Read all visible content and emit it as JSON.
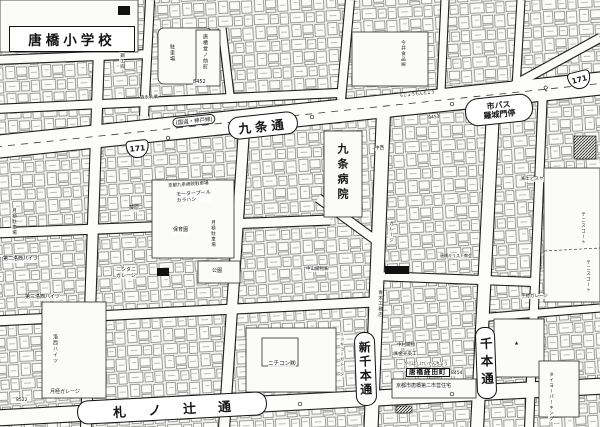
{
  "map": {
    "school_label": "唐橋小学校",
    "hospital_label": "九条病院",
    "streets": {
      "kujo": "九条通",
      "fudanotsuji": "札ノ辻通",
      "shinsenbon": "新千本通",
      "senbon": "千本通"
    },
    "route": {
      "shield": "171",
      "note": "(国道・神戸線)"
    },
    "bus_stop": {
      "text": "市バス\n羅城門停"
    },
    "sheet_numbers": [
      "8452",
      "8453",
      "8454",
      "8522"
    ],
    "labels": [
      {
        "id": "karahashi-dononomae-cho",
        "text": "唐橋堂ノ前町",
        "x": 202,
        "y": 34,
        "size": 5,
        "v": true
      },
      {
        "id": "num-8452",
        "text": "8452",
        "x": 193,
        "y": 80,
        "size": 5
      },
      {
        "id": "parking-lot-label",
        "text": "駐車場",
        "x": 169,
        "y": 44,
        "size": 5,
        "v": true
      },
      {
        "id": "sasai-workshop",
        "text": "笹井鋼工㈲",
        "x": 119,
        "y": 42,
        "size": 4.5,
        "v": true
      },
      {
        "id": "morinaga",
        "text": "森永乳業",
        "x": 140,
        "y": 96,
        "size": 4.5,
        "rot": -3
      },
      {
        "id": "imai-foods",
        "text": "今井食品㈱",
        "x": 400,
        "y": 40,
        "size": 4.5,
        "v": true
      },
      {
        "id": "fujiwara",
        "text": "藤原",
        "x": 129,
        "y": 206,
        "size": 5
      },
      {
        "id": "tsukigime-parking-center",
        "text": "月極駐車場",
        "x": 210,
        "y": 220,
        "size": 4.5,
        "v": true
      },
      {
        "id": "tsukigime-parking-left",
        "text": "月極駐車場",
        "x": 11,
        "y": 208,
        "size": 4.5,
        "v": true
      },
      {
        "id": "kujo-hospital-parking",
        "text": "京都九条病院駐車場",
        "x": 168,
        "y": 184,
        "size": 4.5,
        "rot": -4
      },
      {
        "id": "motorpool-karahashi",
        "text": "モータープール\nカラハシ",
        "x": 176,
        "y": 193,
        "size": 5,
        "rot": -4
      },
      {
        "id": "nursery",
        "text": "保育園",
        "x": 173,
        "y": 228,
        "size": 5
      },
      {
        "id": "nishitani-garage",
        "text": "ニシタニ\nガレージ",
        "x": 116,
        "y": 268,
        "size": 5
      },
      {
        "id": "daini-rakusai-heights",
        "text": "第二洛西ハイツ",
        "x": 3,
        "y": 257,
        "size": 5
      },
      {
        "id": "daisan-rakusai-heights",
        "text": "第三洛西ハイツ",
        "x": 25,
        "y": 295,
        "size": 5
      },
      {
        "id": "rakusai-heights",
        "text": "洛西ハイツ",
        "x": 52,
        "y": 334,
        "size": 5,
        "v": true
      },
      {
        "id": "tsukigime-garage",
        "text": "月極ガレージ",
        "x": 50,
        "y": 390,
        "size": 5
      },
      {
        "id": "num-8522",
        "text": "8522",
        "x": 16,
        "y": 398,
        "size": 4.5
      },
      {
        "id": "park",
        "text": "公園",
        "x": 212,
        "y": 269,
        "size": 5
      },
      {
        "id": "nakayama-orimono",
        "text": "中山織物㈱",
        "x": 306,
        "y": 267,
        "size": 4.5
      },
      {
        "id": "aoki-komuten",
        "text": "青木工務店",
        "x": 377,
        "y": 290,
        "size": 4.5,
        "v": true
      },
      {
        "id": "garage-vertical",
        "text": "ガレージ",
        "x": 388,
        "y": 221,
        "size": 4.5,
        "v": true
      },
      {
        "id": "nakanishi",
        "text": "中西",
        "x": 375,
        "y": 146,
        "size": 4.5
      },
      {
        "id": "nichicon",
        "text": "ニチコン㈱",
        "x": 268,
        "y": 361,
        "size": 5.5
      },
      {
        "id": "rikkyo-garage",
        "text": "リッキョーガレージ",
        "x": 340,
        "y": 332,
        "size": 4,
        "v": true
      },
      {
        "id": "nakamura-orimono",
        "text": "中村織物",
        "x": 397,
        "y": 343,
        "size": 4.5
      },
      {
        "id": "kanemitsu-senko",
        "text": "㈱金光染工",
        "x": 394,
        "y": 352,
        "size": 4.5
      },
      {
        "id": "keiden-furigana",
        "text": "からはしけいでんちょう",
        "x": 404,
        "y": 362,
        "size": 4
      },
      {
        "id": "karahashi-keiden-cho",
        "text": "唐橋経田町",
        "x": 406,
        "y": 368,
        "size": 6.5,
        "style": "bx"
      },
      {
        "id": "num-8454",
        "text": "8454",
        "x": 451,
        "y": 371,
        "size": 4.5
      },
      {
        "id": "municipal-housing",
        "text": "京都市唐橋第二市営住宅",
        "x": 396,
        "y": 384,
        "size": 5
      },
      {
        "id": "ebisuya",
        "text": "㈱エビスヤ",
        "x": 521,
        "y": 177,
        "size": 4.5
      },
      {
        "id": "tennis-court-1",
        "text": "テニスコート",
        "x": 580,
        "y": 212,
        "size": 4.5,
        "v": true
      },
      {
        "id": "tennis-court-2",
        "text": "テニスコート",
        "x": 585,
        "y": 260,
        "size": 4.5,
        "v": true
      },
      {
        "id": "uno-garage",
        "text": "宇野ガレージ",
        "x": 521,
        "y": 294,
        "size": 4.5
      },
      {
        "id": "karahashi-church",
        "text": "唐橋キリスト教会",
        "x": 440,
        "y": 254,
        "size": 4
      },
      {
        "id": "taiyo-parking",
        "text": "タイヨーパーキング",
        "x": 548,
        "y": 372,
        "size": 4.5,
        "v": true
      },
      {
        "id": "rajomon-furigana",
        "text": "らじょうもんちょう",
        "x": 399,
        "y": 94,
        "size": 4,
        "rot": -6
      },
      {
        "id": "num-8453",
        "text": "8453",
        "x": 428,
        "y": 116,
        "size": 4.5,
        "rot": -6
      },
      {
        "id": "bus-stop-symbol-left",
        "text": "♀",
        "x": 247,
        "y": 130,
        "size": 7,
        "rot": -6,
        "style": "sym"
      },
      {
        "id": "bus-stop-symbol-right",
        "text": "♀",
        "x": 543,
        "y": 86,
        "size": 7,
        "rot": -6,
        "style": "sym"
      },
      {
        "id": "triangle-mark",
        "text": "▲",
        "x": 515,
        "y": 341,
        "size": 4,
        "style": "sym"
      }
    ]
  }
}
